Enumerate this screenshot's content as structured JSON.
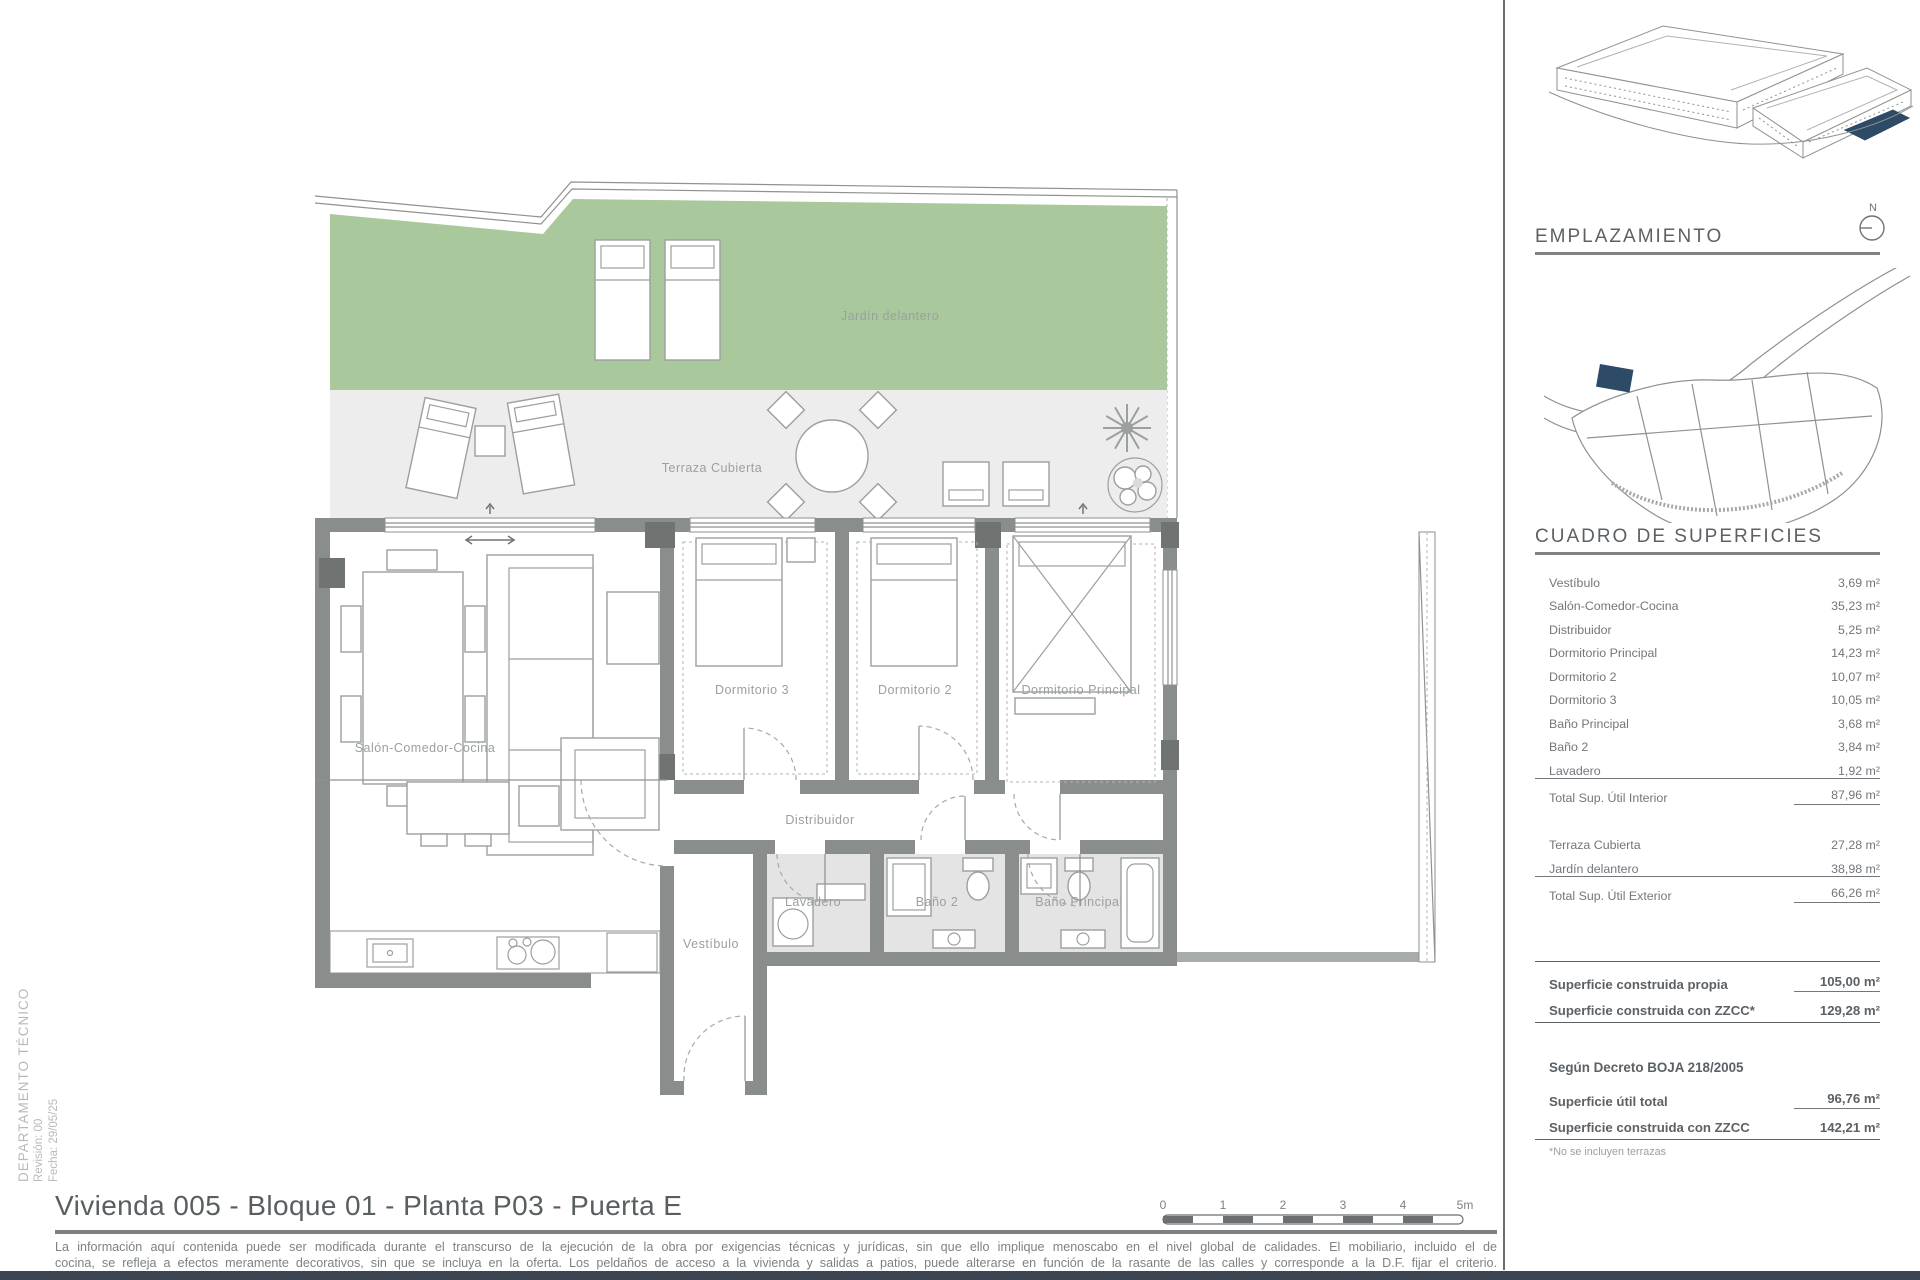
{
  "colors": {
    "accent_blue": "#2d4a66",
    "wall_gray": "#898d8b",
    "garden_green": "#a9c89b",
    "terrace_gray": "#ededed",
    "footer_bar": "#3d4452"
  },
  "side_caption": {
    "department": "DEPARTAMENTO TÉCNICO",
    "revision": "Revisión: 00",
    "date": "Fecha: 29/05/25"
  },
  "plan": {
    "labels": {
      "jardin": "Jardín delantero",
      "terraza": "Terraza Cubierta",
      "salon": "Salón-Comedor-Cocina",
      "dorm3": "Dormitorio 3",
      "dorm2": "Dormitorio 2",
      "dormp": "Dormitorio Principal",
      "distribuidor": "Distribuidor",
      "lavadero": "Lavadero",
      "bano2": "Baño 2",
      "banop": "Baño Principal",
      "vestibulo": "Vestíbulo"
    }
  },
  "sidebar": {
    "emplazamiento_title": "EMPLAZAMIENTO",
    "north_label": "N",
    "surfaces_title": "CUADRO DE SUPERFICIES",
    "interior_rows": [
      {
        "label": "Vestíbulo",
        "value": "3,69 m²"
      },
      {
        "label": "Salón-Comedor-Cocina",
        "value": "35,23 m²"
      },
      {
        "label": "Distribuidor",
        "value": "5,25 m²"
      },
      {
        "label": "Dormitorio Principal",
        "value": "14,23 m²"
      },
      {
        "label": "Dormitorio 2",
        "value": "10,07 m²"
      },
      {
        "label": "Dormitorio 3",
        "value": "10,05 m²"
      },
      {
        "label": "Baño Principal",
        "value": "3,68 m²"
      },
      {
        "label": "Baño 2",
        "value": "3,84 m²"
      },
      {
        "label": "Lavadero",
        "value": "1,92 m²"
      }
    ],
    "interior_total": {
      "label": "Total Sup. Útil Interior",
      "value": "87,96 m²"
    },
    "exterior_rows": [
      {
        "label": "Terraza Cubierta",
        "value": "27,28 m²"
      },
      {
        "label": "Jardín delantero",
        "value": "38,98 m²"
      }
    ],
    "exterior_total": {
      "label": "Total Sup. Útil Exterior",
      "value": "66,26 m²"
    },
    "built_rows": [
      {
        "label": "Superficie construida propia",
        "value": "105,00 m²"
      },
      {
        "label": "Superficie construida con ZZCC*",
        "value": "129,28 m²"
      }
    ],
    "decree_heading": "Según Decreto BOJA 218/2005",
    "decree_rows": [
      {
        "label": "Superficie útil total",
        "value": "96,76 m²"
      },
      {
        "label": "Superficie construida con ZZCC",
        "value": "142,21 m²"
      }
    ],
    "footnote": "*No se incluyen terrazas"
  },
  "footer": {
    "title": "Vivienda 005 - Bloque 01 - Planta P03 - Puerta E",
    "disclaimer_line1": "La información aquí contenida puede ser modificada durante el transcurso de la ejecución de la obra por exigencias técnicas y jurídicas, sin que ello implique menoscabo en el nivel global de calidades. El mobiliario, incluido el de",
    "disclaimer_line2": "cocina, se refleja a efectos meramente decorativos, sin que se incluya en la oferta. Los peldaños de acceso a la vivienda y salidas a patios, puede alterarse en función de la rasante de las calles y corresponde a la D.F. fijar el criterio.",
    "scale_labels": [
      "0",
      "1",
      "2",
      "3",
      "4",
      "5m"
    ]
  }
}
